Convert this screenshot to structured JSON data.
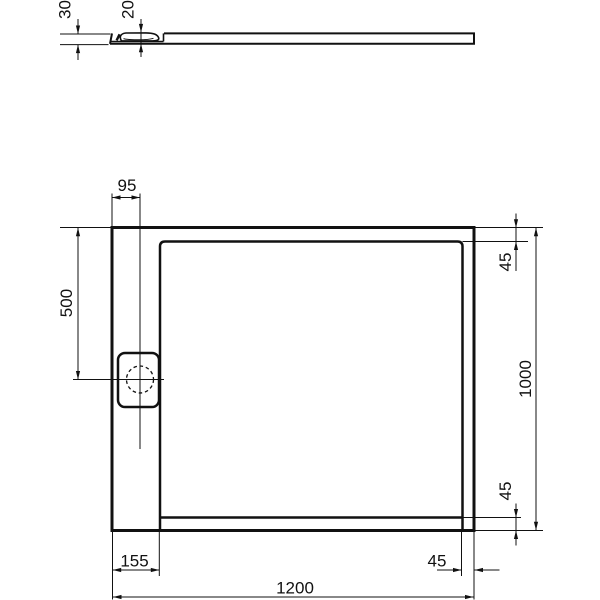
{
  "drawing": {
    "side_view": {
      "overall_height": "30",
      "drain_cover_height": "20"
    },
    "plan_view": {
      "drain_center_from_left": "95",
      "drain_center_from_top": "500",
      "top_edge_band": "45",
      "depth": "1000",
      "bottom_edge_band": "45",
      "left_drain_band": "155",
      "right_edge_band": "45",
      "width": "1200"
    },
    "style": {
      "line_color": "#111111",
      "background_color": "#ffffff"
    }
  }
}
